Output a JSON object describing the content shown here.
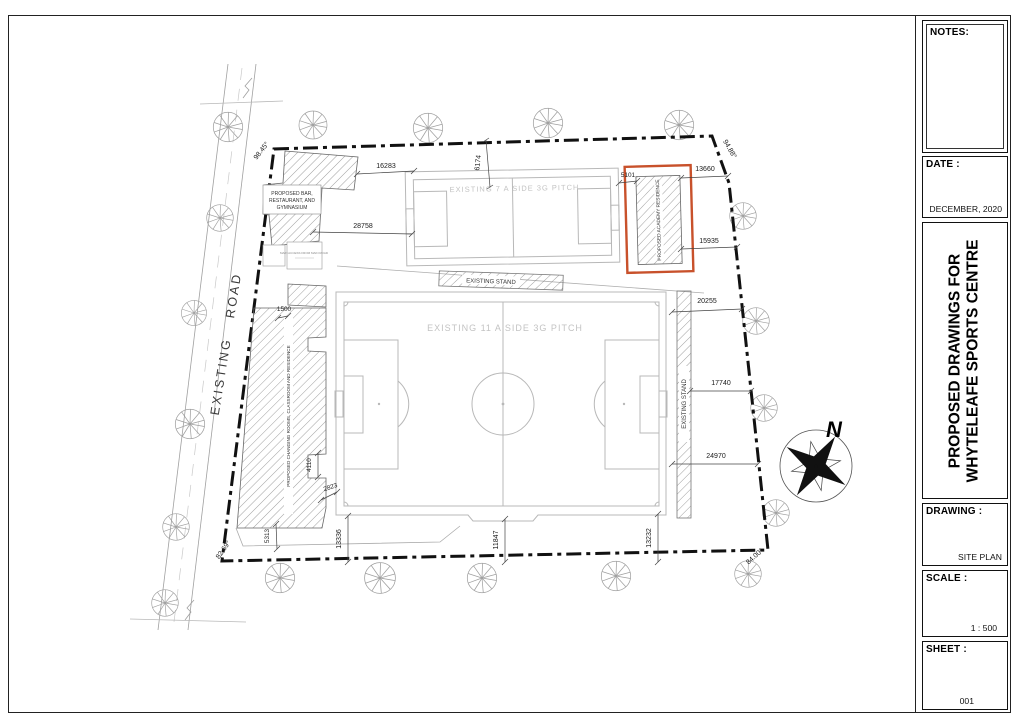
{
  "page": {
    "background": "#ffffff",
    "border_color": "#222222"
  },
  "title_block": {
    "notes_label": "NOTES:",
    "date_label": "DATE :",
    "date_value": "DECEMBER, 2020",
    "project_title_line1": "PROPOSED DRAWINGS FOR",
    "project_title_line2": "WHYTELEAFE SPORTS CENTRE",
    "drawing_label": "DRAWING :",
    "drawing_value": "SITE PLAN",
    "scale_label": "SCALE :",
    "scale_value": "1 : 500",
    "sheet_label": "SHEET :",
    "sheet_value": "001"
  },
  "site_plan": {
    "north_label": "N",
    "road_label": "EXISTING ROAD",
    "pitch_7_label": "EXISTING 7 A SIDE 3G PITCH",
    "pitch_11_label": "EXISTING 11 A SIDE 3G PITCH",
    "stand_top_label": "EXISTING STAND",
    "stand_right_label": "EXISTING STAND",
    "building_bar_line1": "PROPOSED BAR,",
    "building_bar_line2": "RESTAURANT, AND",
    "building_bar_line3": "GYMNASIUM",
    "building_changing_label": "PROPOSED CHANGING ROOMS, CLASSROOM AND RESIDENCE",
    "building_academy_label": "PROPOSED ACADEMY RESIDENCE",
    "small_annotation": "MAIN ACCESS FROM MAIN ROAD",
    "highlight_color": "#c8512b",
    "angles": {
      "top_left": "98.45°",
      "top_right": "94.88°",
      "bottom_left": "82.69°",
      "bottom_right": "84.00°"
    },
    "dimensions": {
      "bar_to_pitch": "16283",
      "bar_to_pitch_lower": "28758",
      "boundary_to_pitch7": "6174",
      "pitch7_to_academy": "5101",
      "academy_to_boundary_top": "13660",
      "academy_to_boundary_bottom": "15935",
      "stand_to_boundary_top": "20255",
      "stand_to_boundary_mid": "17740",
      "stand_to_boundary_bottom": "24970",
      "changing_offset": "1500",
      "changing_notch_height": "4110",
      "changing_notch_width": "2823",
      "changing_to_boundary": "5313",
      "pitch11_left_to_boundary": "13336",
      "pitch11_mid_to_boundary": "11847",
      "pitch11_right_to_boundary": "13232"
    }
  }
}
